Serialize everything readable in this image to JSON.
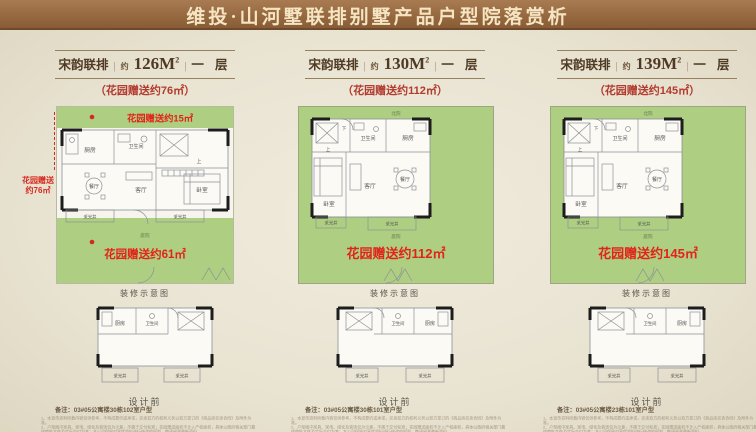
{
  "banner": {
    "title": "维投·山河墅联排别墅产品户型院落赏析"
  },
  "shared": {
    "sep": "|",
    "caption_decor": "装修示意图",
    "caption_design": "设计前",
    "rooms": {
      "kitchen": "厨房",
      "bath": "卫生间",
      "dining": "餐厅",
      "living": "客厅",
      "bedroom": "卧室",
      "up": "上",
      "down": "下",
      "lightwell": "采光井",
      "yard": "庭院",
      "north_yard": "北院"
    },
    "disc1": "1、本宣传资料所载内容仅供参考，不构成要约或承诺，买卖双方的权利义务以双方签订的《商品房买卖合同》及附件为准。",
    "disc2": "2、户型图中家具、家电、绿化及装饰仅为示意，不属于交付标准；花园赠送面积不计入产权面积，具体以政府相关部门最终审批文件及实际交付为准；本公司保留对宣传资料进行修改的权利，敬请留意最新资料。",
    "disc3": "3、本资料所涉面积均为建筑面积约数，最终以权属登记机关实测面积为准；部分图片来源于网络，如有侵权请联系删除。"
  },
  "columns": [
    {
      "series": "宋韵联排",
      "approx": "约",
      "area": "126M",
      "area_sup": "2",
      "floor": "一 层",
      "garden_note": "（花园赠送约76㎡）",
      "garden_top": "花园赠送约15㎡",
      "garden_side_1": "花园赠送",
      "garden_side_2": "约76㎡",
      "garden_main": "花园赠送约61㎡",
      "note": "备注：03#05公寓楼30栋102室户型"
    },
    {
      "series": "宋韵联排",
      "approx": "约",
      "area": "130M",
      "area_sup": "2",
      "floor": "一 层",
      "garden_note": "（花园赠送约112㎡）",
      "garden_main": "花园赠送约112㎡",
      "note": "备注：03#05公寓楼30栋101室户型"
    },
    {
      "series": "宋韵联排",
      "approx": "约",
      "area": "139M",
      "area_sup": "2",
      "floor": "一 层",
      "garden_note": "（花园赠送约145㎡）",
      "garden_main": "花园赠送约145㎡",
      "note": "备注：03#05公寓楼23栋101室户型"
    }
  ]
}
